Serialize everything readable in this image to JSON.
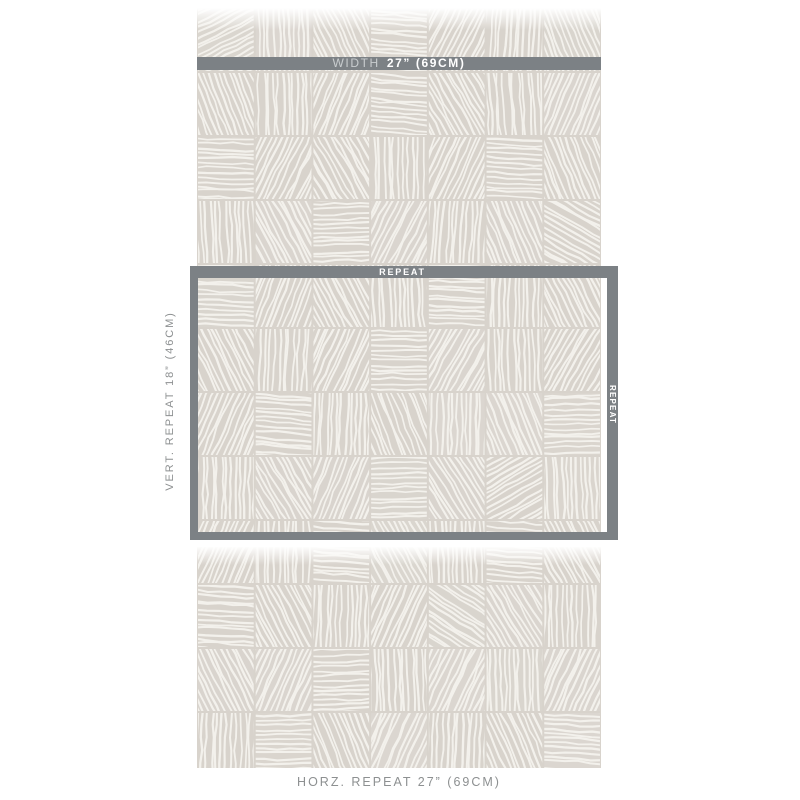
{
  "page": {
    "background_color": "#ffffff"
  },
  "swatch": {
    "kind": "wallpaper-swatch-photo",
    "background_color": "#d8d3cc",
    "stroke_color": "#f3f1ec",
    "pattern_grid": {
      "cols": 7,
      "rows": 12,
      "cell_width": 57.71,
      "cell_height": 64,
      "line_spacing": 4.8,
      "directions": [
        [
          "f",
          "v",
          "d1",
          "h",
          "d2",
          "v",
          "d1"
        ],
        [
          "d1",
          "v",
          "d2",
          "h",
          "d1",
          "v",
          "d2"
        ],
        [
          "h",
          "d2",
          "d1",
          "v",
          "d2",
          "h",
          "d1"
        ],
        [
          "v",
          "d1",
          "h",
          "d2",
          "v",
          "d1",
          "e"
        ],
        [
          "h",
          "d2",
          "d1",
          "v",
          "h",
          "v",
          "d1"
        ],
        [
          "d1",
          "v",
          "d2",
          "h",
          "d2",
          "v",
          "d2"
        ],
        [
          "d2",
          "h",
          "v",
          "d1",
          "v",
          "d1",
          "h"
        ],
        [
          "v",
          "d1",
          "d2",
          "h",
          "d1",
          "f",
          "v"
        ],
        [
          "d2",
          "v",
          "h",
          "d1",
          "v",
          "h",
          "d1"
        ],
        [
          "h",
          "d1",
          "v",
          "d2",
          "e",
          "d1",
          "v"
        ],
        [
          "d1",
          "d2",
          "h",
          "v",
          "d2",
          "v",
          "d2"
        ],
        [
          "v",
          "h",
          "d1",
          "d2",
          "v",
          "d1",
          "h"
        ]
      ]
    }
  },
  "labels": {
    "width_bar": {
      "prefix": "WIDTH",
      "value": "27” (69CM)"
    },
    "repeat_box": {
      "top": "REPEAT",
      "right": "REPEAT"
    },
    "vertical": "VERT. REPEAT 18” (46CM)",
    "horizontal": "HORZ. REPEAT 27” (69CM)"
  },
  "colors": {
    "annotation_bar": "#7c8185",
    "annotation_text_light": "#c9cdcf",
    "annotation_text_white": "#ffffff",
    "measure_text": "#8d9091"
  }
}
